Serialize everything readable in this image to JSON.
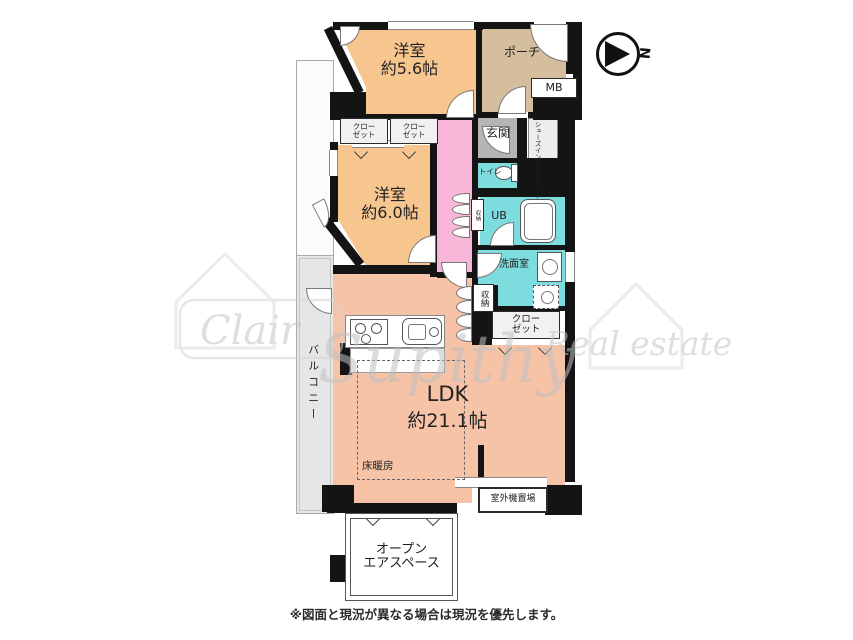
{
  "plan": {
    "bedroom1": {
      "name": "洋室",
      "size": "約5.6帖"
    },
    "bedroom2": {
      "name": "洋室",
      "size": "約6.0帖"
    },
    "ldk": {
      "name": "LDK",
      "size": "約21.1帖"
    },
    "porch": "ポーチ",
    "meter_box": "MB",
    "closet_line1": "クロー",
    "closet_line2": "ゼット",
    "entrance": "玄関",
    "shoes_in_closet_col1": "シューズイン",
    "shoes_in_closet_col2": "クローゼット",
    "toilet": "トイレ",
    "unit_bath": "UB",
    "washroom": "洗面室",
    "storage": "収納",
    "balcony": "バルコニー",
    "floor_heating": "床暖房",
    "outdoor_unit": "室外機置場",
    "open_air_line1": "オープン",
    "open_air_line2": "エアスペース"
  },
  "compass": {
    "north": "N"
  },
  "watermark": {
    "left": "Clair",
    "script": "Supithy",
    "right": "Real estate"
  },
  "footer": {
    "disclaimer": "※図面と現況が異なる場合は現況を優先します。"
  },
  "colors": {
    "wall": "#141414",
    "bedroom": "#f7c68e",
    "porch": "#d5be9e",
    "corridor": "#f8b6d8",
    "wet_area": "#7ddcdd",
    "ldk": "#f6c3a6",
    "entrance": "#b5b5b5",
    "balcony": "#e6e6e6",
    "closet": "#f1f1f1"
  }
}
